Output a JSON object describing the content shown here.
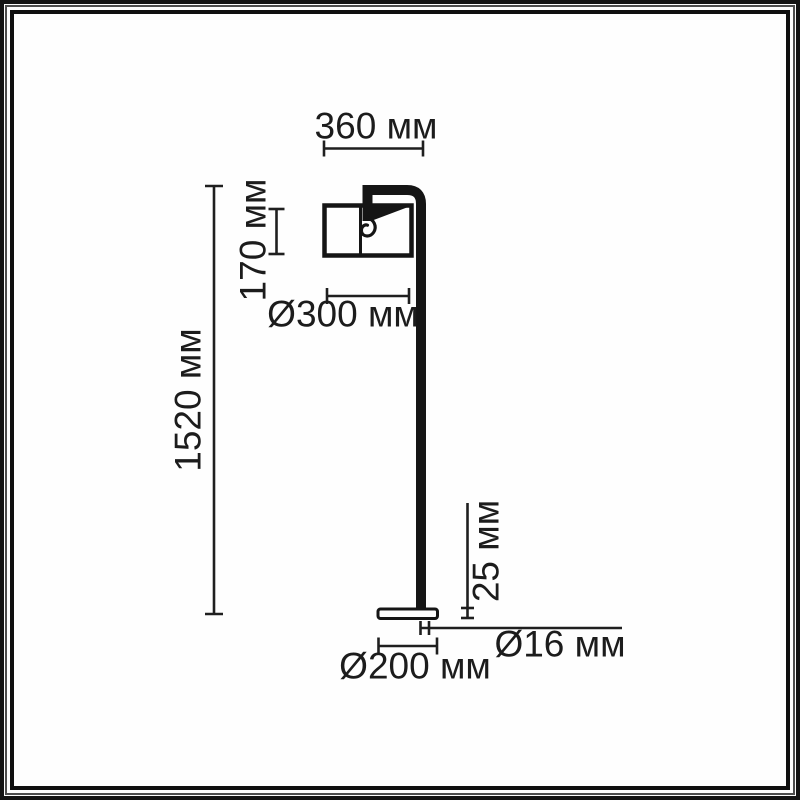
{
  "document": {
    "type": "technical dimensional drawing",
    "subject": "floor lamp with cylindrical shade and round base",
    "unit": "мм"
  },
  "colors": {
    "ink": "#151515",
    "dimension_ink": "#1f1f1f",
    "background": "#fefefe",
    "frame": "#141414"
  },
  "dimensions": {
    "arm_reach": {
      "label": "360 мм",
      "value": 360,
      "meaning": "horizontal span of shade and arm"
    },
    "shade_height": {
      "label": "170 мм",
      "value": 170,
      "meaning": "lampshade height"
    },
    "shade_diameter": {
      "label": "Ø300 мм",
      "value": 300,
      "meaning": "lampshade diameter"
    },
    "total_height": {
      "label": "1520 мм",
      "value": 1520,
      "meaning": "overall lamp height"
    },
    "base_height": {
      "label": "25 мм",
      "value": 25,
      "meaning": "base plate thickness"
    },
    "pole_diameter": {
      "label": "Ø16 мм",
      "value": 16,
      "meaning": "pole tube diameter"
    },
    "base_diameter": {
      "label": "Ø200 мм",
      "value": 200,
      "meaning": "base plate diameter"
    }
  }
}
